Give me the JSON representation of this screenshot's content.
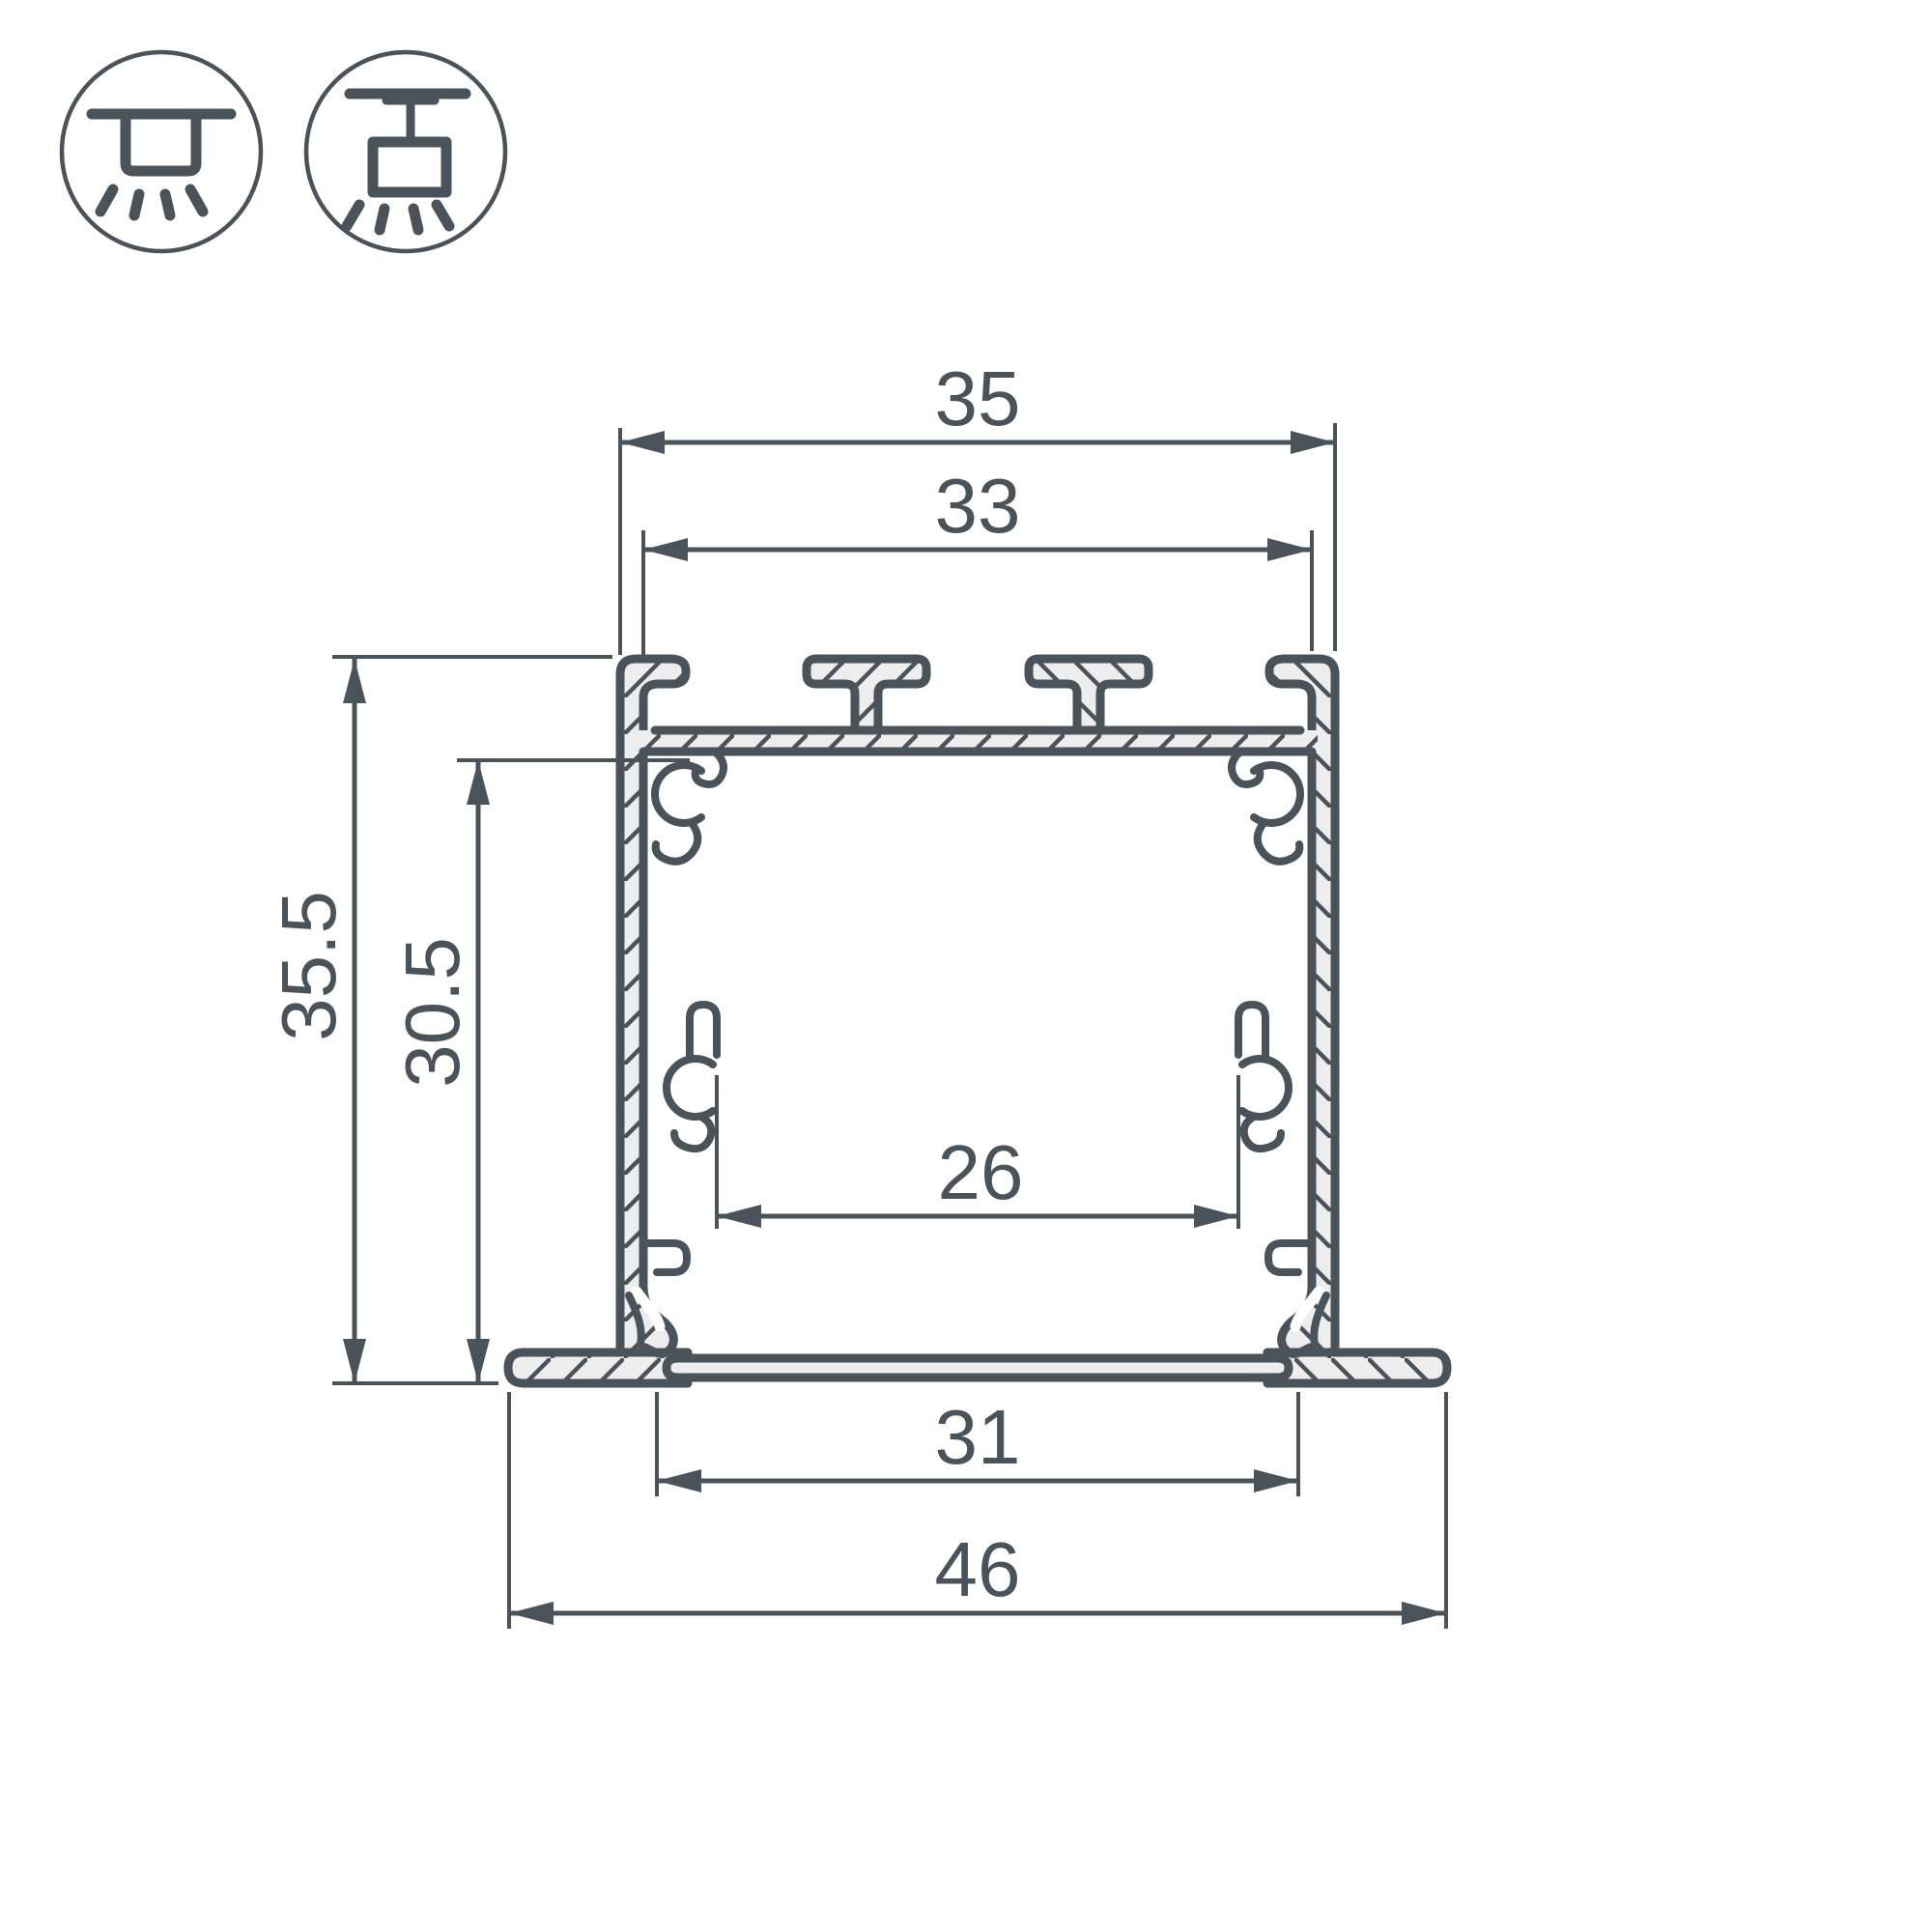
{
  "icons": {
    "recessed_mount": "recessed-mount-icon",
    "surface_mount": "surface-mount-icon"
  },
  "dimensions": {
    "top_width": "35",
    "top_opening_width": "33",
    "overall_height": "35.5",
    "inner_height": "30.5",
    "inner_width": "26",
    "base_width": "31",
    "overall_width": "46"
  },
  "colors": {
    "line": "#4a535a",
    "fill": "#ededee",
    "background": "#ffffff"
  }
}
